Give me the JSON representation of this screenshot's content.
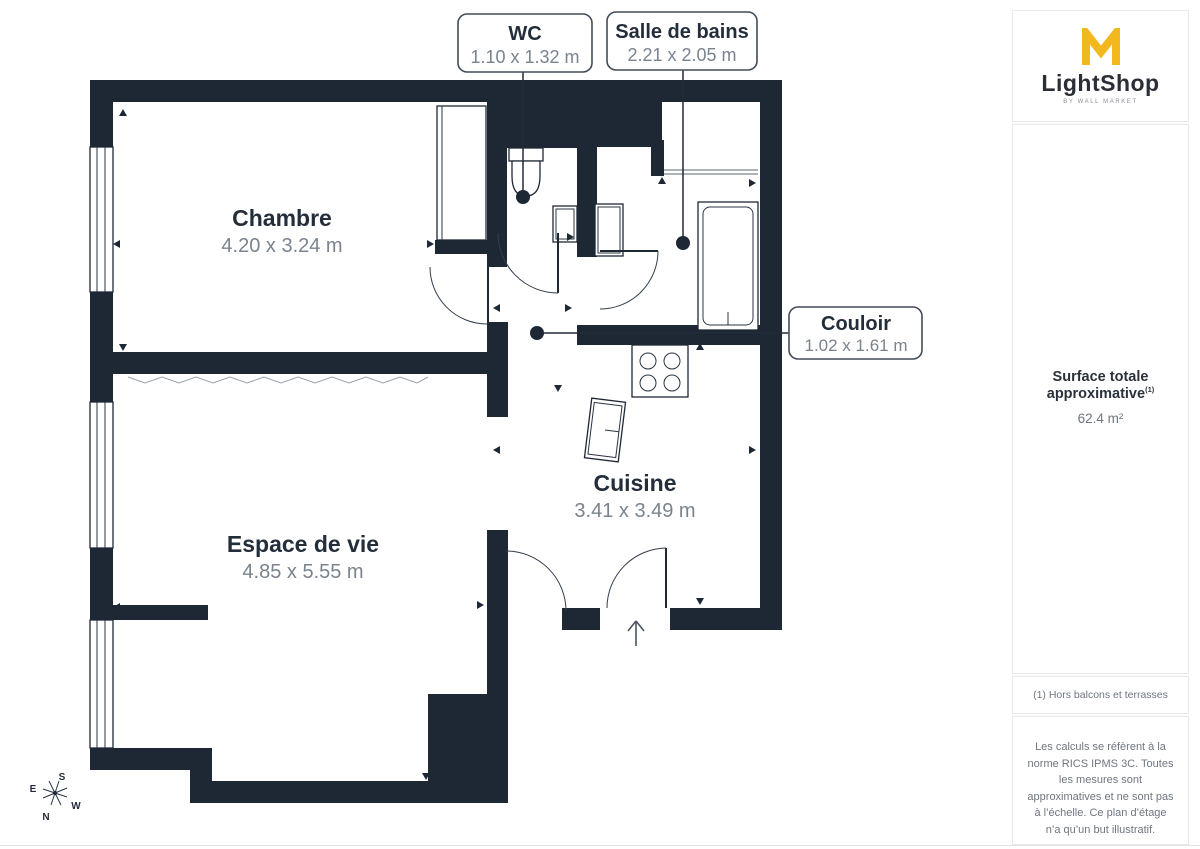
{
  "plan": {
    "rooms": [
      {
        "id": "chambre",
        "name": "Chambre",
        "dimensions": "4.20 x 3.24 m"
      },
      {
        "id": "espace-de-vie",
        "name": "Espace de vie",
        "dimensions": "4.85 x 5.55 m"
      },
      {
        "id": "cuisine",
        "name": "Cuisine",
        "dimensions": "3.41 x 3.49 m"
      }
    ],
    "callouts": [
      {
        "id": "wc",
        "name": "WC",
        "dimensions": "1.10 x 1.32 m"
      },
      {
        "id": "salle-de-bains",
        "name": "Salle de bains",
        "dimensions": "2.21 x 2.05 m"
      },
      {
        "id": "couloir",
        "name": "Couloir",
        "dimensions": "1.02 x 1.61 m"
      }
    ],
    "compass": {
      "north": "N",
      "south": "S",
      "east": "E",
      "west": "W"
    }
  },
  "sidebar": {
    "logo": {
      "brand": "LightShop",
      "tagline": "BY WALL MARKET"
    },
    "surface": {
      "label": "Surface totale approximative",
      "superscript": "(1)",
      "value": "62.4 m²"
    },
    "footnote": "(1) Hors balcons et terrasses",
    "disclaimer": "Les calculs se réfèrent à la norme RICS IPMS 3C. Toutes les mesures sont approximatives et ne sont pas à l’échelle. Ce plan d’étage n’a qu’un but illustratif.",
    "brand_footer": {
      "name": "GIRAFFE",
      "suffix": "360"
    }
  },
  "colors": {
    "wall": "#1e2835",
    "accent": "#f3b81e",
    "dim_text": "#7a838e",
    "border": "#e9e9e9"
  }
}
